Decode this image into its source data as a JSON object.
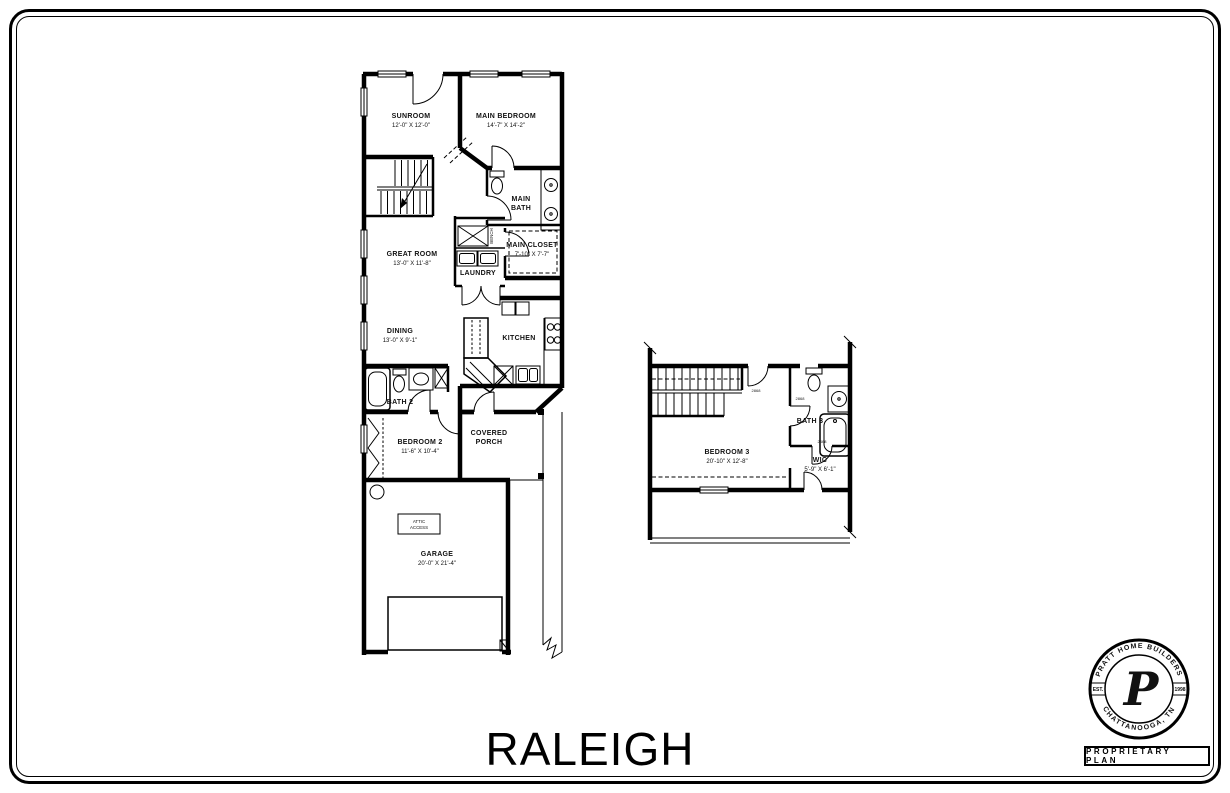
{
  "title": "RALEIGH",
  "first_floor": {
    "rooms": {
      "sunroom": {
        "name": "SUNROOM",
        "dims": "12'-0\" X 12'-0\""
      },
      "main_bedroom": {
        "name": "MAIN BEDROOM",
        "dims": "14'-7\" X 14'-2\""
      },
      "main_bath": {
        "line1": "MAIN",
        "line2": "BATH"
      },
      "main_closet": {
        "name": "MAIN CLOSET",
        "dims": "7'-10\" X 7'-7\""
      },
      "bench": {
        "name": "BENCH"
      },
      "laundry": {
        "name": "LAUNDRY"
      },
      "great_room": {
        "name": "GREAT ROOM",
        "dims": "13'-0\" X 11'-8\""
      },
      "dining": {
        "name": "DINING",
        "dims": "13'-0\" X 9'-1\""
      },
      "kitchen": {
        "name": "KITCHEN"
      },
      "bath2": {
        "name": "BATH 2"
      },
      "bedroom2": {
        "name": "BEDROOM 2",
        "dims": "11'-6\" X 10'-4\""
      },
      "covered_porch": {
        "line1": "COVERED",
        "line2": "PORCH"
      },
      "garage": {
        "name": "GARAGE",
        "dims": "20'-0\" X 21'-4\""
      },
      "attic_access": {
        "line1": "ATTIC",
        "line2": "ACCESS"
      }
    }
  },
  "second_floor": {
    "rooms": {
      "bedroom3": {
        "name": "BEDROOM 3",
        "dims": "20'-10\" X 12'-8\""
      },
      "bath3": {
        "name": "BATH 3"
      },
      "wic": {
        "name": "WIC",
        "dims": "5'-9\" X 6'-1\""
      }
    },
    "door_tags": [
      "2868",
      "2868",
      "2468"
    ]
  },
  "logo": {
    "arc_top": "PRATT HOME BUILDERS",
    "arc_bottom": "CHATTANOOGA, TN",
    "est": "EST.",
    "year": "1998",
    "monogram": "P",
    "plate": "PROPRIETARY PLAN"
  }
}
